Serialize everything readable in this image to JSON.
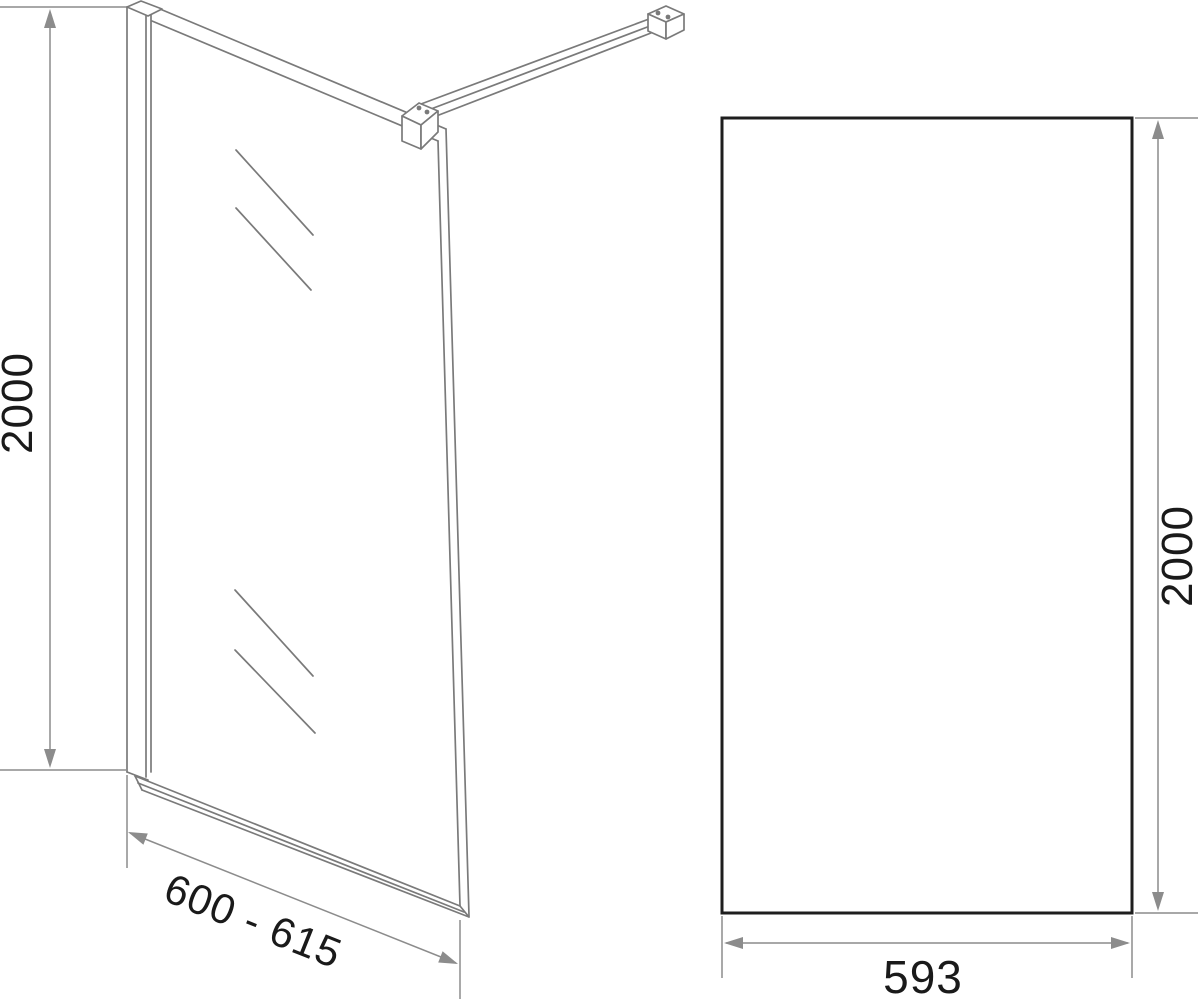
{
  "drawing": {
    "kind": "technical-dimension-drawing",
    "subject": "walk-in shower glass screen",
    "perspective_view": {
      "height_label": "2000",
      "width_label": "600 - 615"
    },
    "front_view": {
      "height_label": "2000",
      "width_label": "593"
    },
    "colors": {
      "drawing_line": "#7a7a7a",
      "dimension_line": "#8c8c8c",
      "panel_outline": "#1e1e1e",
      "label_text": "#1a1a1a",
      "background": "#ffffff"
    }
  }
}
